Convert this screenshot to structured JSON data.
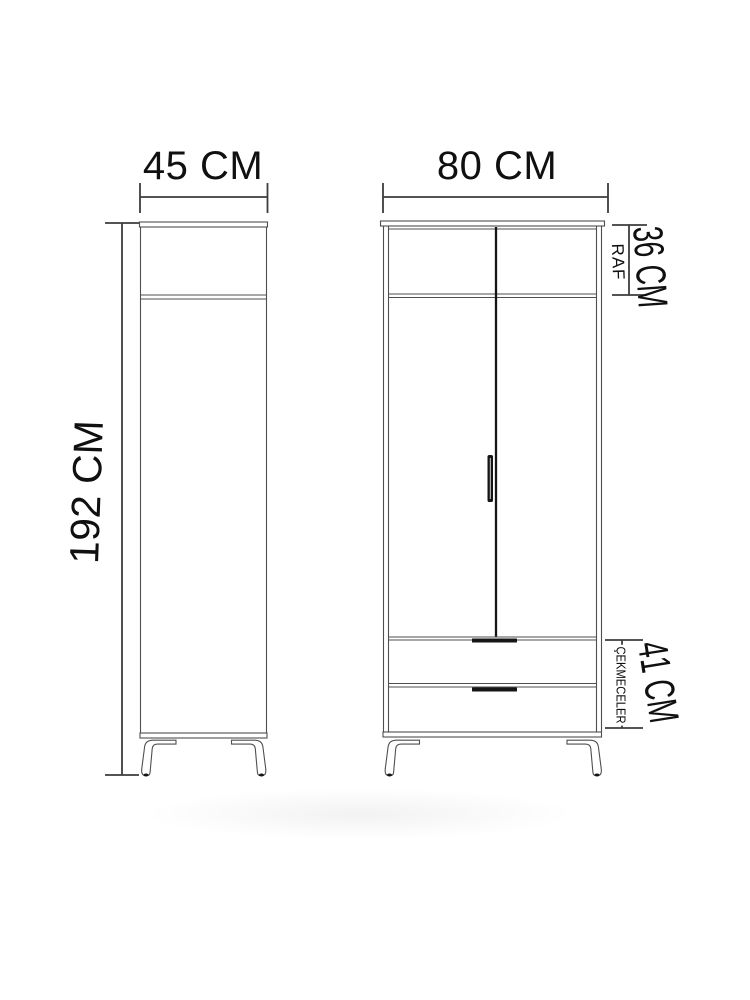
{
  "diagram_title": "wardrobe-dimension-drawing",
  "views": {
    "side": {
      "width_label": "45 CM",
      "height_label": "192 CM"
    },
    "front": {
      "width_label": "80 CM",
      "shelf_dim_label": "36 CM",
      "shelf_name_label": "RAF",
      "drawers_dim_label": "41 CM",
      "drawers_name_label": "ÇEKMECELER"
    }
  },
  "colors": {
    "background": "#ffffff",
    "cabinet_line": "#4f4f4f",
    "dimension_line": "#3d3d3d",
    "text": "#101010",
    "dark_detail": "#151515"
  }
}
